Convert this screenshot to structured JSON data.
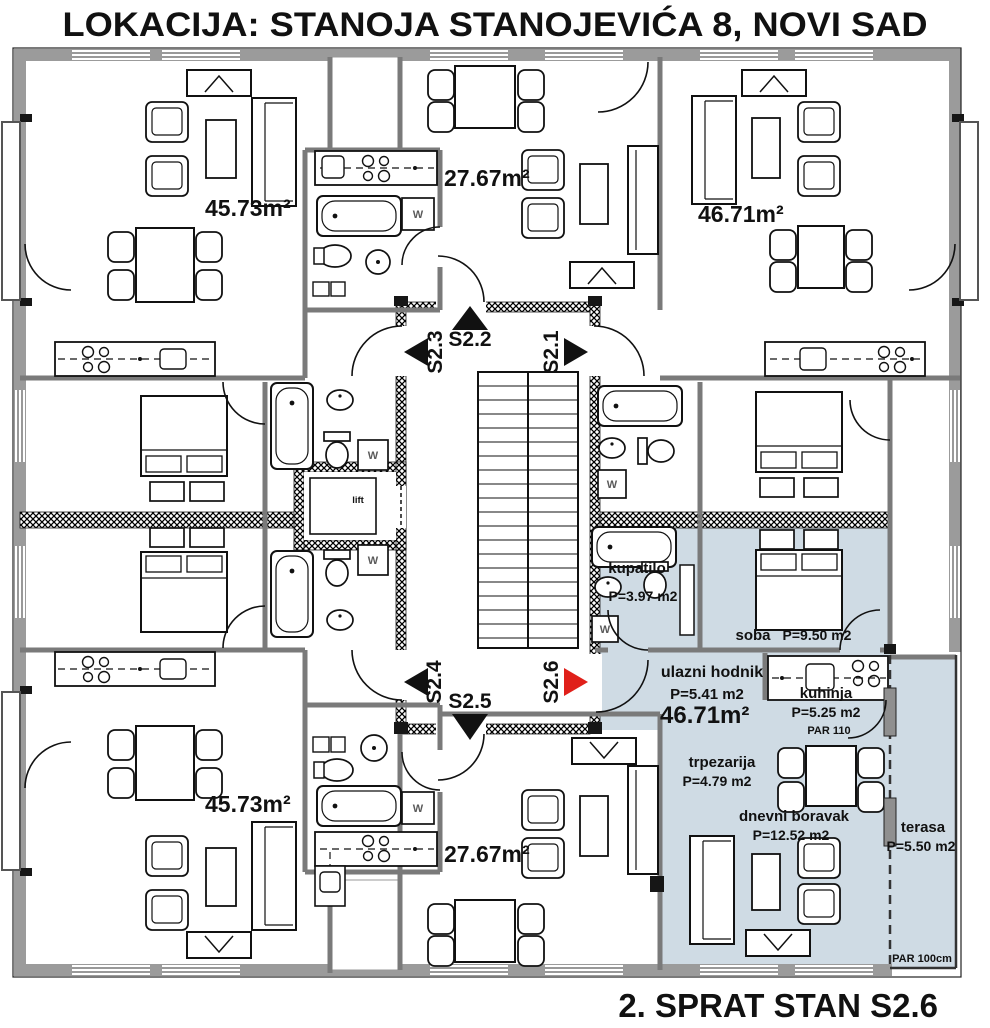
{
  "header": {
    "title": "LOKACIJA: STANOJA STANOJEVIĆA 8, NOVI SAD"
  },
  "footer": {
    "caption": "2. SPRAT STAN S2.6"
  },
  "colors": {
    "highlight": "#cfdbe4",
    "accent_red": "#e0201a",
    "wall_gray": "#9b9b9b"
  },
  "apartments": {
    "top_left": {
      "area": "45.73m²"
    },
    "top_center": {
      "area": "27.67m²"
    },
    "top_right": {
      "area": "46.71m²"
    },
    "bottom_left": {
      "area": "45.73m²"
    },
    "bottom_center": {
      "area": "27.67m²"
    }
  },
  "core": {
    "lift_label": "lift",
    "stair_labels": {
      "s21": "S2.1",
      "s22": "S2.2",
      "s23": "S2.3",
      "s24": "S2.4",
      "s25": "S2.5",
      "s26": "S2.6"
    }
  },
  "unit": {
    "id": "S2.6",
    "total_area": "46.71m²",
    "rooms": {
      "kupatilo": {
        "name": "kupatilo",
        "area": "P=3.97 m2"
      },
      "soba": {
        "name": "soba",
        "area": "P=9.50 m2"
      },
      "ulazni_hodnik": {
        "name": "ulazni hodnik",
        "area": "P=5.41 m2"
      },
      "kuhinja": {
        "name": "kuhinja",
        "area": "P=5.25 m2"
      },
      "trpezarija": {
        "name": "trpezarija",
        "area": "P=4.79 m2"
      },
      "dnevni_boravak": {
        "name": "dnevni boravak",
        "area": "P=12.52 m2"
      },
      "terasa": {
        "name": "terasa",
        "area": "P=5.50 m2"
      }
    },
    "parapet_kitchen": "PAR 110",
    "parapet_terrace": "PAR 100cm"
  },
  "labels": {
    "washer": "W"
  }
}
